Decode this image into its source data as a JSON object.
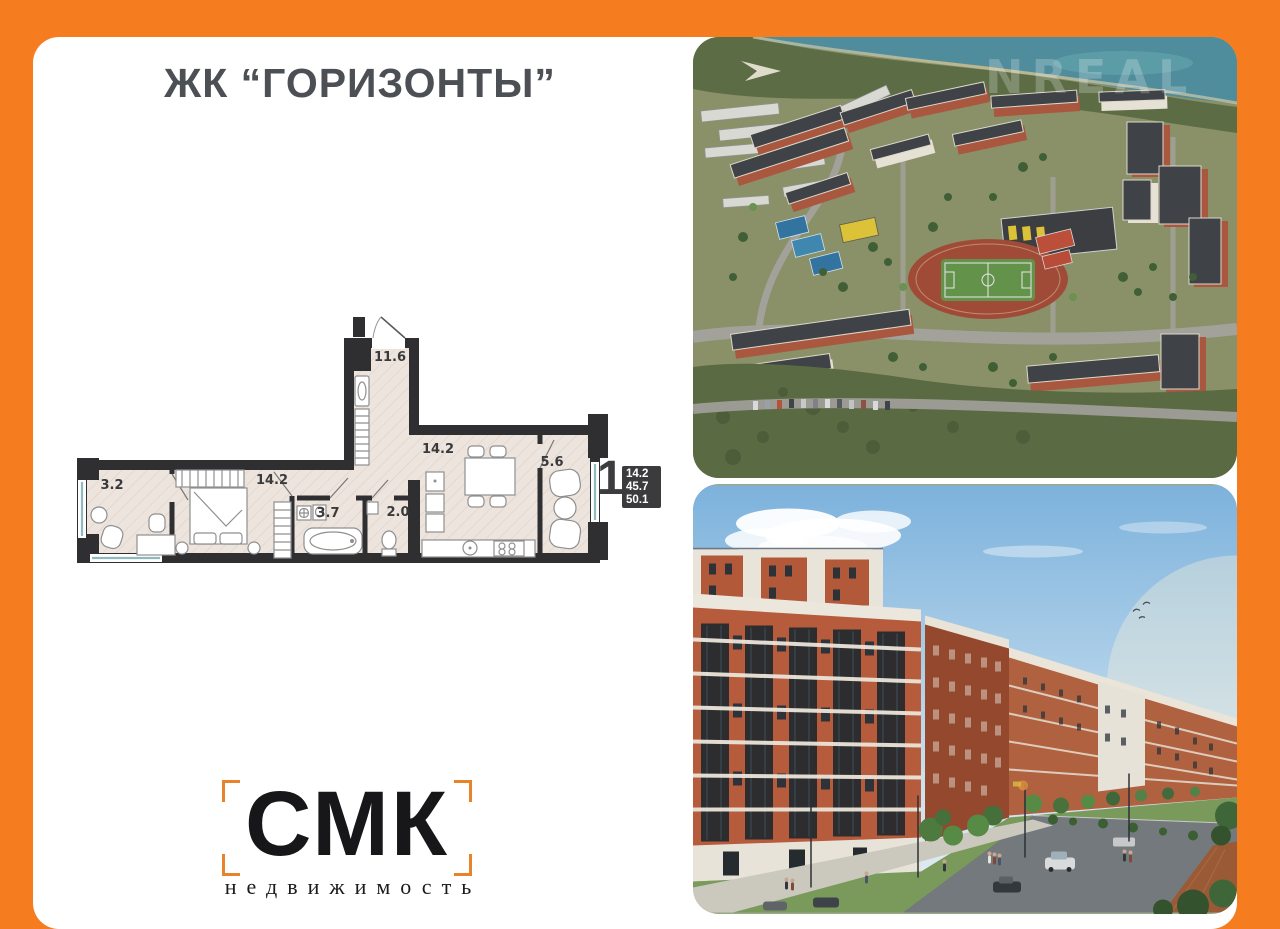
{
  "header": {
    "title": "ЖК “ГОРИЗОНТЫ”"
  },
  "floor_plan": {
    "rooms": [
      {
        "name": "loggia",
        "area": "3.2"
      },
      {
        "name": "bedroom",
        "area": "14.2"
      },
      {
        "name": "hall",
        "area": "11.6"
      },
      {
        "name": "bathroom",
        "area": "3.7"
      },
      {
        "name": "wc",
        "area": "2.0"
      },
      {
        "name": "kitchen-living",
        "area": "14.2"
      },
      {
        "name": "loggia-2",
        "area": "5.6"
      }
    ],
    "summary": {
      "rooms_count": "1",
      "living_area": "14.2",
      "apartment_area": "45.7",
      "total_area": "50.1"
    }
  },
  "photos": {
    "aerial_watermark": "NREAL"
  },
  "logo": {
    "name": "СМК",
    "tagline": "недвижимость"
  },
  "colors": {
    "frame_orange": "#f57d1f",
    "logo_bracket_orange": "#e8832c",
    "plan_wall": "#2f2f31",
    "badge_bg": "#3b3b3d",
    "title_text": "#4c4f54"
  }
}
